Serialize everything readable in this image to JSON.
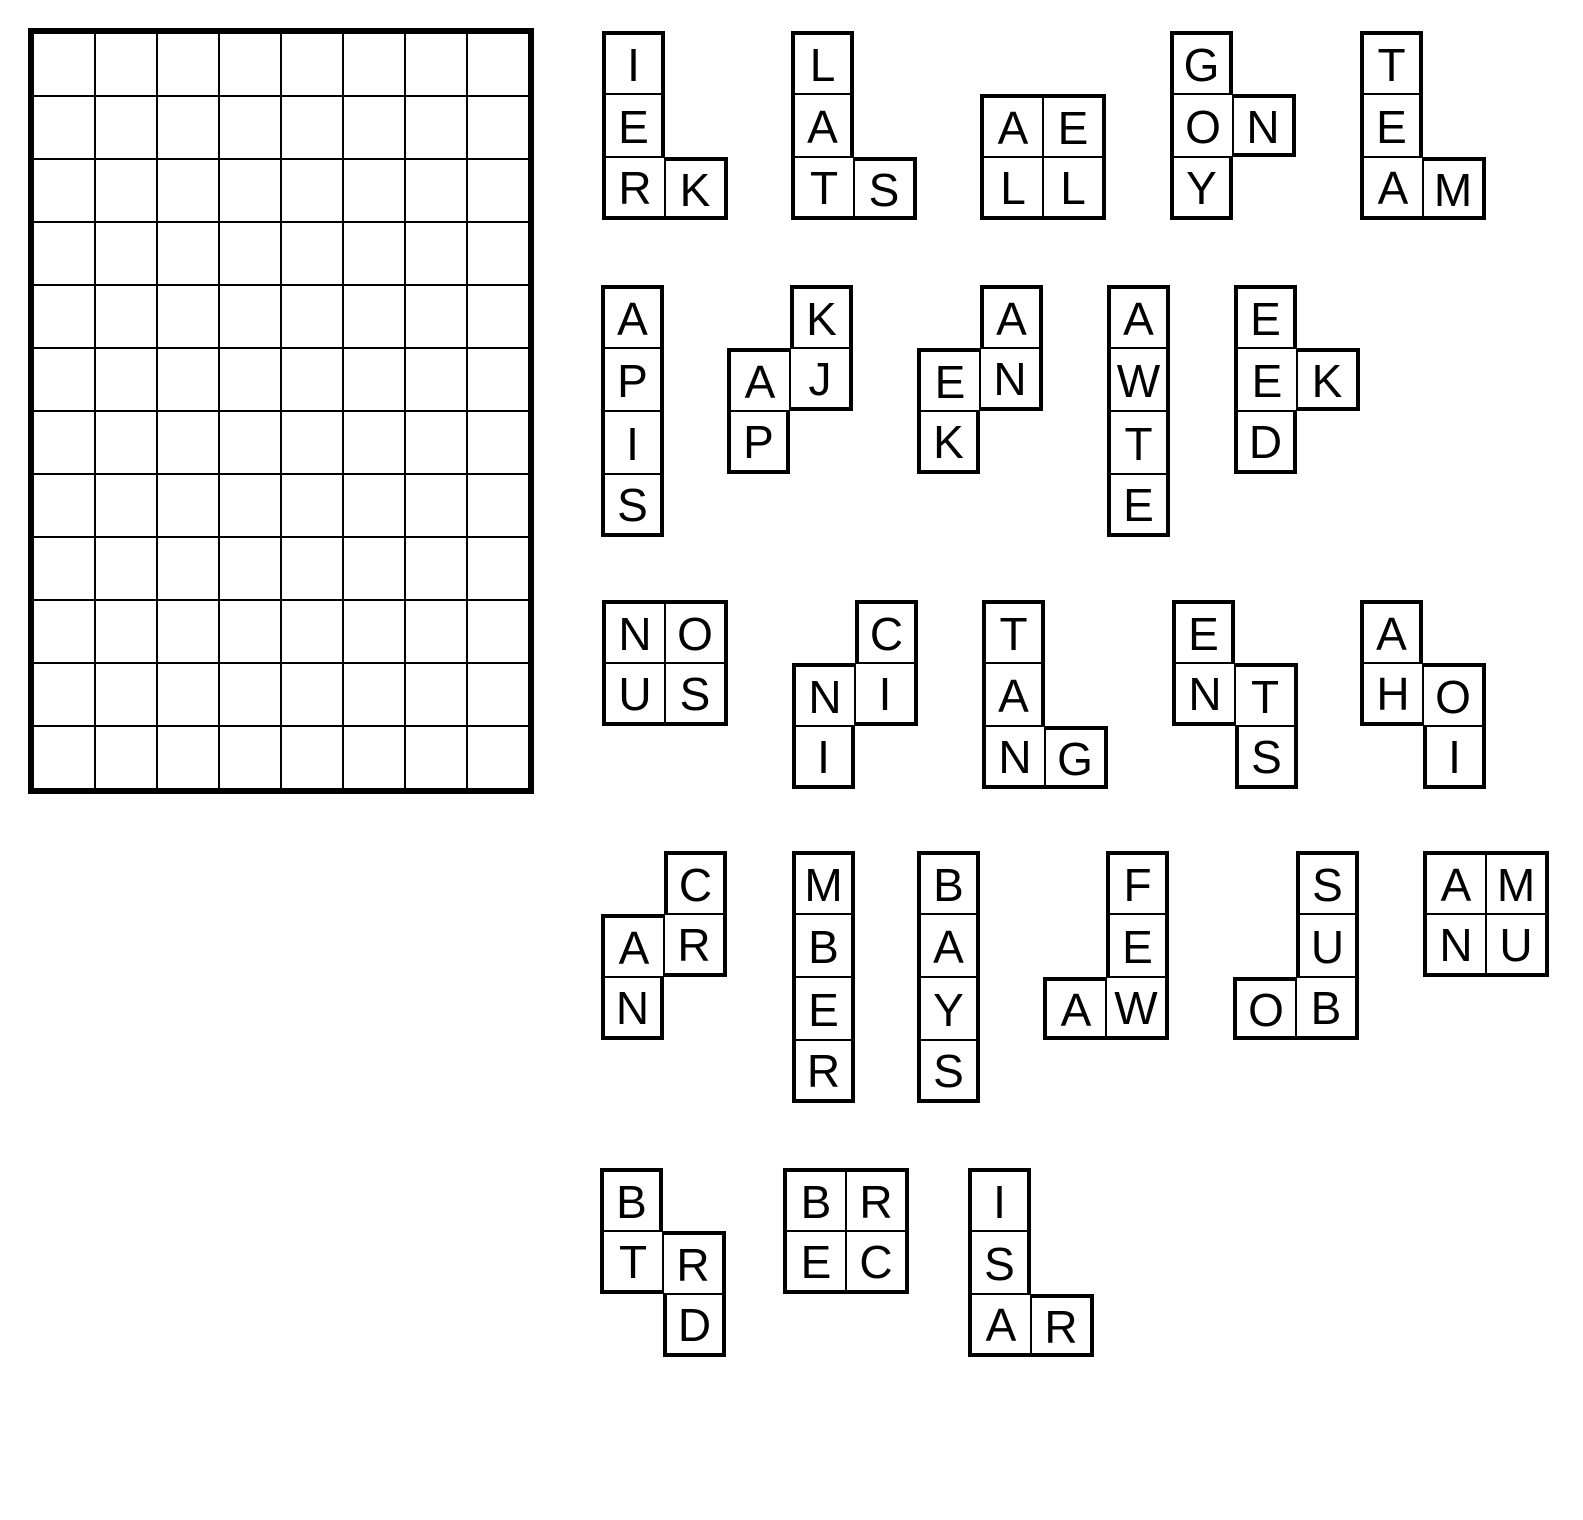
{
  "puzzle": {
    "colors": {
      "line": "#000000",
      "background": "#ffffff"
    },
    "grid": {
      "cols": 8,
      "rows": 12,
      "cell_width": 62,
      "cell_height": 63,
      "left": 28,
      "top": 28
    },
    "piece_cell_size": 63,
    "pieces": [
      {
        "id": "piece-ierk",
        "left": 602,
        "top": 31,
        "cells": [
          {
            "c": 0,
            "r": 0,
            "letter": "I"
          },
          {
            "c": 0,
            "r": 1,
            "letter": "E"
          },
          {
            "c": 0,
            "r": 2,
            "letter": "R"
          },
          {
            "c": 1,
            "r": 2,
            "letter": "K"
          }
        ]
      },
      {
        "id": "piece-lats",
        "left": 791,
        "top": 31,
        "cells": [
          {
            "c": 0,
            "r": 0,
            "letter": "L"
          },
          {
            "c": 0,
            "r": 1,
            "letter": "A"
          },
          {
            "c": 0,
            "r": 2,
            "letter": "T"
          },
          {
            "c": 1,
            "r": 2,
            "letter": "S"
          }
        ]
      },
      {
        "id": "piece-aell",
        "left": 980,
        "top": 94,
        "cells": [
          {
            "c": 0,
            "r": 0,
            "letter": "A"
          },
          {
            "c": 1,
            "r": 0,
            "letter": "E"
          },
          {
            "c": 0,
            "r": 1,
            "letter": "L"
          },
          {
            "c": 1,
            "r": 1,
            "letter": "L"
          }
        ]
      },
      {
        "id": "piece-gony",
        "left": 1170,
        "top": 31,
        "cells": [
          {
            "c": 0,
            "r": 0,
            "letter": "G"
          },
          {
            "c": 0,
            "r": 1,
            "letter": "O"
          },
          {
            "c": 1,
            "r": 1,
            "letter": "N"
          },
          {
            "c": 0,
            "r": 2,
            "letter": "Y"
          }
        ]
      },
      {
        "id": "piece-team",
        "left": 1360,
        "top": 31,
        "cells": [
          {
            "c": 0,
            "r": 0,
            "letter": "T"
          },
          {
            "c": 0,
            "r": 1,
            "letter": "E"
          },
          {
            "c": 0,
            "r": 2,
            "letter": "A"
          },
          {
            "c": 1,
            "r": 2,
            "letter": "M"
          }
        ]
      },
      {
        "id": "piece-apis",
        "left": 601,
        "top": 285,
        "cells": [
          {
            "c": 0,
            "r": 0,
            "letter": "A"
          },
          {
            "c": 0,
            "r": 1,
            "letter": "P"
          },
          {
            "c": 0,
            "r": 2,
            "letter": "I"
          },
          {
            "c": 0,
            "r": 3,
            "letter": "S"
          }
        ]
      },
      {
        "id": "piece-kajp",
        "left": 727,
        "top": 285,
        "cells": [
          {
            "c": 1,
            "r": 0,
            "letter": "K"
          },
          {
            "c": 0,
            "r": 1,
            "letter": "A"
          },
          {
            "c": 1,
            "r": 1,
            "letter": "J"
          },
          {
            "c": 0,
            "r": 2,
            "letter": "P"
          }
        ]
      },
      {
        "id": "piece-aenk",
        "left": 917,
        "top": 285,
        "cells": [
          {
            "c": 1,
            "r": 0,
            "letter": "A"
          },
          {
            "c": 0,
            "r": 1,
            "letter": "E"
          },
          {
            "c": 1,
            "r": 1,
            "letter": "N"
          },
          {
            "c": 0,
            "r": 2,
            "letter": "K"
          }
        ]
      },
      {
        "id": "piece-awte",
        "left": 1107,
        "top": 285,
        "cells": [
          {
            "c": 0,
            "r": 0,
            "letter": "A"
          },
          {
            "c": 0,
            "r": 1,
            "letter": "W"
          },
          {
            "c": 0,
            "r": 2,
            "letter": "T"
          },
          {
            "c": 0,
            "r": 3,
            "letter": "E"
          }
        ]
      },
      {
        "id": "piece-eekd",
        "left": 1234,
        "top": 285,
        "cells": [
          {
            "c": 0,
            "r": 0,
            "letter": "E"
          },
          {
            "c": 0,
            "r": 1,
            "letter": "E"
          },
          {
            "c": 1,
            "r": 1,
            "letter": "K"
          },
          {
            "c": 0,
            "r": 2,
            "letter": "D"
          }
        ]
      },
      {
        "id": "piece-nous",
        "left": 602,
        "top": 600,
        "cells": [
          {
            "c": 0,
            "r": 0,
            "letter": "N"
          },
          {
            "c": 1,
            "r": 0,
            "letter": "O"
          },
          {
            "c": 0,
            "r": 1,
            "letter": "U"
          },
          {
            "c": 1,
            "r": 1,
            "letter": "S"
          }
        ]
      },
      {
        "id": "piece-cnii",
        "left": 792,
        "top": 600,
        "cells": [
          {
            "c": 1,
            "r": 0,
            "letter": "C"
          },
          {
            "c": 0,
            "r": 1,
            "letter": "N"
          },
          {
            "c": 1,
            "r": 1,
            "letter": "I"
          },
          {
            "c": 0,
            "r": 2,
            "letter": "I"
          }
        ]
      },
      {
        "id": "piece-tang",
        "left": 982,
        "top": 600,
        "cells": [
          {
            "c": 0,
            "r": 0,
            "letter": "T"
          },
          {
            "c": 0,
            "r": 1,
            "letter": "A"
          },
          {
            "c": 0,
            "r": 2,
            "letter": "N"
          },
          {
            "c": 1,
            "r": 2,
            "letter": "G"
          }
        ]
      },
      {
        "id": "piece-ents",
        "left": 1172,
        "top": 600,
        "cells": [
          {
            "c": 0,
            "r": 0,
            "letter": "E"
          },
          {
            "c": 0,
            "r": 1,
            "letter": "N"
          },
          {
            "c": 1,
            "r": 1,
            "letter": "T"
          },
          {
            "c": 1,
            "r": 2,
            "letter": "S"
          }
        ]
      },
      {
        "id": "piece-ahoi",
        "left": 1360,
        "top": 600,
        "cells": [
          {
            "c": 0,
            "r": 0,
            "letter": "A"
          },
          {
            "c": 0,
            "r": 1,
            "letter": "H"
          },
          {
            "c": 1,
            "r": 1,
            "letter": "O"
          },
          {
            "c": 1,
            "r": 2,
            "letter": "I"
          }
        ]
      },
      {
        "id": "piece-carn",
        "left": 601,
        "top": 851,
        "cells": [
          {
            "c": 1,
            "r": 0,
            "letter": "C"
          },
          {
            "c": 0,
            "r": 1,
            "letter": "A"
          },
          {
            "c": 1,
            "r": 1,
            "letter": "R"
          },
          {
            "c": 0,
            "r": 2,
            "letter": "N"
          }
        ]
      },
      {
        "id": "piece-mber",
        "left": 792,
        "top": 851,
        "cells": [
          {
            "c": 0,
            "r": 0,
            "letter": "M"
          },
          {
            "c": 0,
            "r": 1,
            "letter": "B"
          },
          {
            "c": 0,
            "r": 2,
            "letter": "E"
          },
          {
            "c": 0,
            "r": 3,
            "letter": "R"
          }
        ]
      },
      {
        "id": "piece-bays",
        "left": 917,
        "top": 851,
        "cells": [
          {
            "c": 0,
            "r": 0,
            "letter": "B"
          },
          {
            "c": 0,
            "r": 1,
            "letter": "A"
          },
          {
            "c": 0,
            "r": 2,
            "letter": "Y"
          },
          {
            "c": 0,
            "r": 3,
            "letter": "S"
          }
        ]
      },
      {
        "id": "piece-feaw",
        "left": 1043,
        "top": 851,
        "cells": [
          {
            "c": 1,
            "r": 0,
            "letter": "F"
          },
          {
            "c": 1,
            "r": 1,
            "letter": "E"
          },
          {
            "c": 0,
            "r": 2,
            "letter": "A"
          },
          {
            "c": 1,
            "r": 2,
            "letter": "W"
          }
        ]
      },
      {
        "id": "piece-suob",
        "left": 1233,
        "top": 851,
        "cells": [
          {
            "c": 1,
            "r": 0,
            "letter": "S"
          },
          {
            "c": 1,
            "r": 1,
            "letter": "U"
          },
          {
            "c": 0,
            "r": 2,
            "letter": "O"
          },
          {
            "c": 1,
            "r": 2,
            "letter": "B"
          }
        ]
      },
      {
        "id": "piece-amnu",
        "left": 1423,
        "top": 851,
        "cells": [
          {
            "c": 0,
            "r": 0,
            "letter": "A"
          },
          {
            "c": 1,
            "r": 0,
            "letter": "M"
          },
          {
            "c": 0,
            "r": 1,
            "letter": "N"
          },
          {
            "c": 1,
            "r": 1,
            "letter": "U"
          }
        ]
      },
      {
        "id": "piece-btrd",
        "left": 600,
        "top": 1168,
        "cells": [
          {
            "c": 0,
            "r": 0,
            "letter": "B"
          },
          {
            "c": 0,
            "r": 1,
            "letter": "T"
          },
          {
            "c": 1,
            "r": 1,
            "letter": "R"
          },
          {
            "c": 1,
            "r": 2,
            "letter": "D"
          }
        ]
      },
      {
        "id": "piece-brec",
        "left": 783,
        "top": 1168,
        "cells": [
          {
            "c": 0,
            "r": 0,
            "letter": "B"
          },
          {
            "c": 1,
            "r": 0,
            "letter": "R"
          },
          {
            "c": 0,
            "r": 1,
            "letter": "E"
          },
          {
            "c": 1,
            "r": 1,
            "letter": "C"
          }
        ]
      },
      {
        "id": "piece-isar",
        "left": 968,
        "top": 1168,
        "cells": [
          {
            "c": 0,
            "r": 0,
            "letter": "I"
          },
          {
            "c": 0,
            "r": 1,
            "letter": "S"
          },
          {
            "c": 0,
            "r": 2,
            "letter": "A"
          },
          {
            "c": 1,
            "r": 2,
            "letter": "R"
          }
        ]
      }
    ]
  }
}
